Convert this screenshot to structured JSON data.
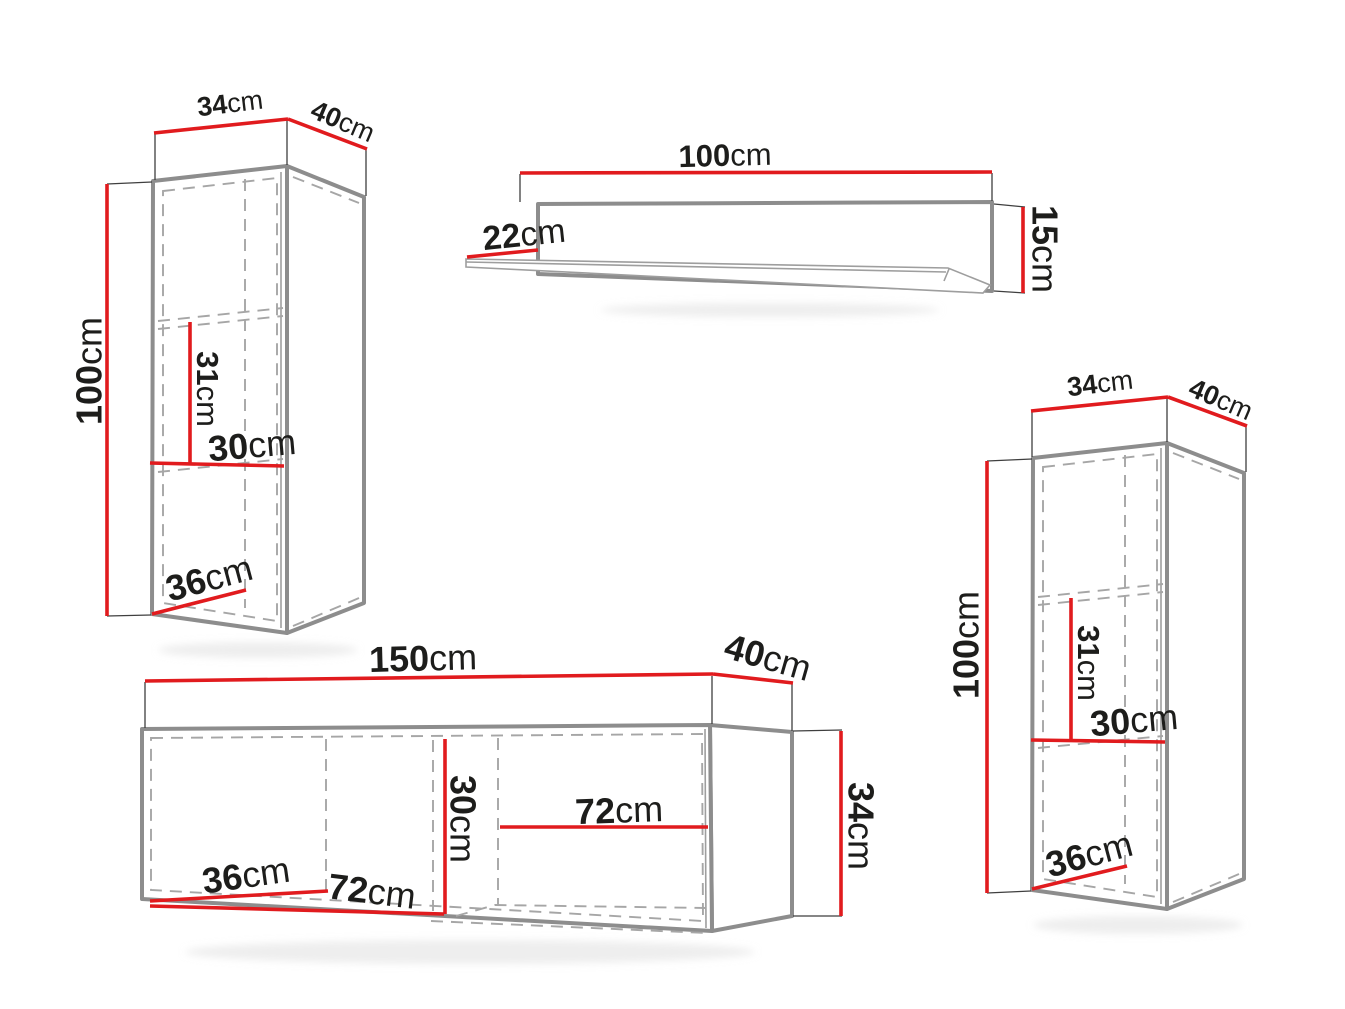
{
  "colors": {
    "dimension_line": "#e11b1e",
    "outline": "#8d8d8d",
    "hidden_line": "#a6a6a6",
    "text": "#1d1d1b"
  },
  "pieces": {
    "cabinet_left": {
      "top_width": {
        "value": "34",
        "unit": "cm"
      },
      "top_depth": {
        "value": "40",
        "unit": "cm"
      },
      "height": {
        "value": "100",
        "unit": "cm"
      },
      "shelf_offset": {
        "value": "31",
        "unit": "cm"
      },
      "inner_width": {
        "value": "30",
        "unit": "cm"
      },
      "inner_depth": {
        "value": "36",
        "unit": "cm"
      }
    },
    "wall_shelf": {
      "width": {
        "value": "100",
        "unit": "cm"
      },
      "depth": {
        "value": "22",
        "unit": "cm"
      },
      "height": {
        "value": "15",
        "unit": "cm"
      }
    },
    "tv_stand": {
      "width": {
        "value": "150",
        "unit": "cm"
      },
      "top_depth": {
        "value": "40",
        "unit": "cm"
      },
      "inner_height": {
        "value": "30",
        "unit": "cm"
      },
      "inner_depth": {
        "value": "36",
        "unit": "cm"
      },
      "left_compartment_width": {
        "value": "72",
        "unit": "cm"
      },
      "right_compartment_width": {
        "value": "72",
        "unit": "cm"
      },
      "height": {
        "value": "34",
        "unit": "cm"
      }
    },
    "cabinet_right": {
      "top_width": {
        "value": "34",
        "unit": "cm"
      },
      "top_depth": {
        "value": "40",
        "unit": "cm"
      },
      "height": {
        "value": "100",
        "unit": "cm"
      },
      "shelf_offset": {
        "value": "31",
        "unit": "cm"
      },
      "inner_width": {
        "value": "30",
        "unit": "cm"
      },
      "inner_depth": {
        "value": "36",
        "unit": "cm"
      }
    }
  }
}
